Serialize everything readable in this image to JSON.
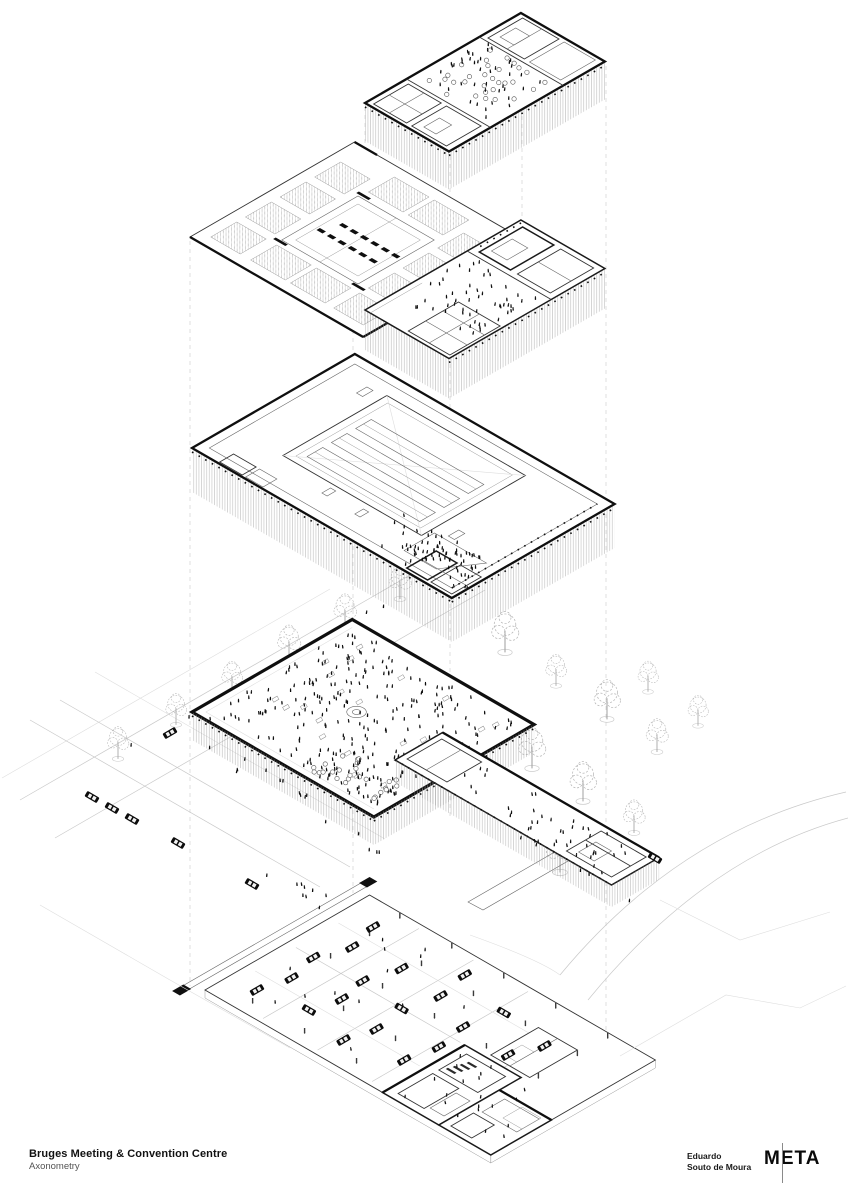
{
  "colors": {
    "ink": "#111111",
    "paper": "#ffffff",
    "light_line": "#c9c9c9"
  },
  "title_block": {
    "project_title": "Bruges Meeting & Convention Centre",
    "drawing_title": "Axonometry"
  },
  "credits": {
    "architect_line1": "Eduardo",
    "architect_line2": "Souto de Moura",
    "studio_logo_text": "META"
  }
}
